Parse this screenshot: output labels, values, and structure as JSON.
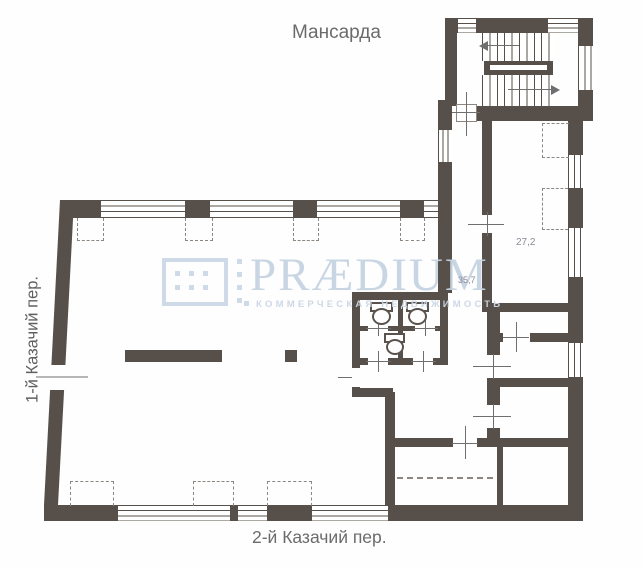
{
  "title": "Мансарда",
  "streets": {
    "left": "1-й Казачий пер.",
    "bottom": "2-й Казачий пер."
  },
  "rooms": [
    {
      "area_label": "27,2"
    },
    {
      "area_label": "35,7"
    }
  ],
  "watermark": {
    "brand": "PRÆDIUM",
    "tagline": "КОММЕРЧЕСКАЯ НЕДВИЖИМОСТЬ"
  },
  "colors": {
    "wall": "#57504a",
    "watermark": "#ccd9e6",
    "label_text": "#6b6b6b",
    "room_label": "#8b8c97"
  }
}
